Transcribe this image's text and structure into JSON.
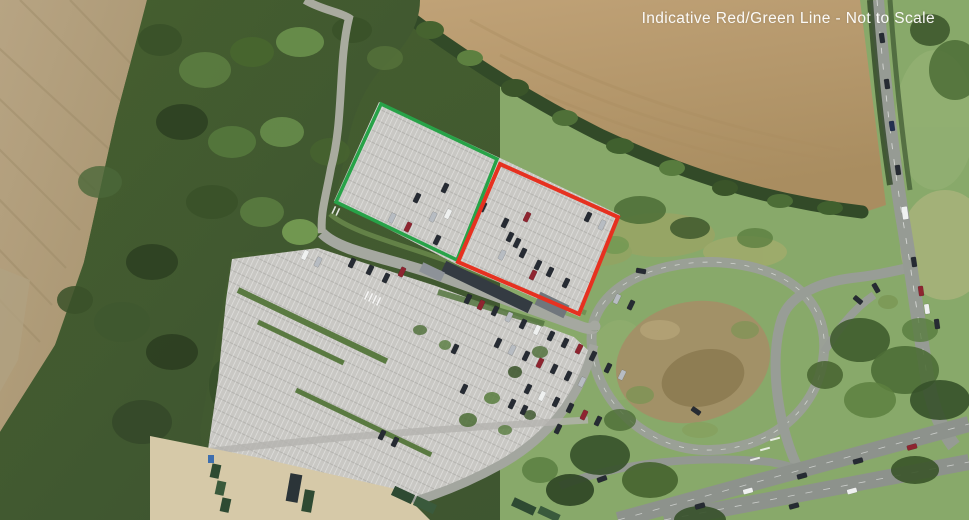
{
  "annotation": {
    "label": "Indicative Red/Green Line - Not to Scale",
    "label_color": "#ffffff",
    "green_line": {
      "color": "#27a348",
      "points": "381,104 497,159 457,260 336,202"
    },
    "red_line": {
      "color": "#e63120",
      "points": "500,164 618,217 579,314 458,262"
    }
  },
  "scene": {
    "type": "aerial-photograph",
    "features": [
      "arable-field-northwest",
      "arable-field-northeast",
      "woodland-west",
      "hedgerow-boundary",
      "park-and-ride-car-park",
      "parked-cars",
      "bus-shelter",
      "service-yard-containers",
      "internal-access-road",
      "access-loop-road",
      "scrub-mound",
      "road-junction",
      "main-road",
      "dual-carriageway",
      "grass-verges",
      "tree-clusters"
    ]
  }
}
